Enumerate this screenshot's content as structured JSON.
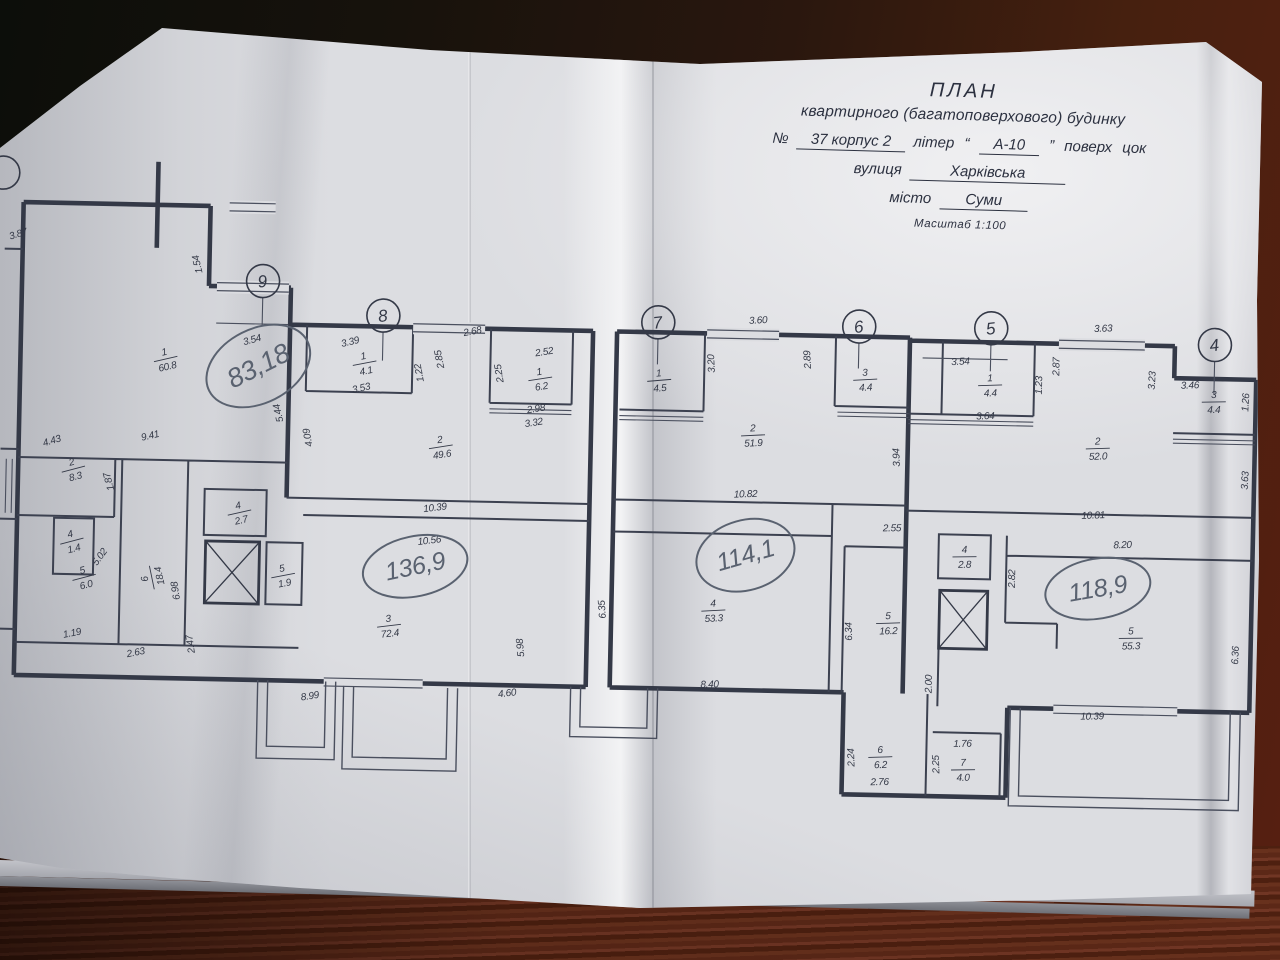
{
  "document": {
    "title1": "ПЛАН",
    "title2": "квартирного (багатоповерхового) будинку",
    "number_label": "№",
    "number_value": "37 корпус 2",
    "liter_label": "літер",
    "liter_open": "“",
    "liter_value": "А-10",
    "liter_close": "”",
    "floor_label": "поверх",
    "floor_value": "цок",
    "street_label": "вулиця",
    "street_value": "Харківська",
    "city_label": "місто",
    "city_value": "Суми",
    "scale_text": "Масштаб 1:100"
  },
  "colors": {
    "ink": "#343947",
    "pen": "#5a6270",
    "paper": "#dcdde1"
  },
  "axis_markers": [
    {
      "n": "9",
      "x": 259,
      "y": 289
    },
    {
      "n": "8",
      "x": 380,
      "y": 321
    },
    {
      "n": "7",
      "x": 655,
      "y": 322
    },
    {
      "n": "6",
      "x": 856,
      "y": 322
    },
    {
      "n": "5",
      "x": 988,
      "y": 321
    },
    {
      "n": "4",
      "x": 1212,
      "y": 333
    },
    {
      "n": "",
      "x": -3,
      "y": 186
    }
  ],
  "handwritten_totals": [
    {
      "t": "83,18",
      "x": 256,
      "y": 374,
      "r": -28,
      "rx": 55,
      "ry": 37,
      "fs": 27
    },
    {
      "t": "136,9",
      "x": 417,
      "y": 571,
      "r": -13,
      "rx": 53,
      "ry": 30,
      "fs": 25
    },
    {
      "t": "114,1",
      "x": 747,
      "y": 553,
      "r": -17,
      "rx": 50,
      "ry": 35,
      "fs": 25
    },
    {
      "t": "118,9",
      "x": 1100,
      "y": 579,
      "r": -11,
      "rx": 53,
      "ry": 30,
      "fs": 25
    }
  ],
  "rooms": [
    {
      "n": "1",
      "a": "60.8",
      "x": 163,
      "y": 368,
      "r": -14
    },
    {
      "n": "2",
      "a": "8.3",
      "x": 73,
      "y": 480,
      "r": -16
    },
    {
      "n": "4",
      "a": "1.4",
      "x": 73,
      "y": 552,
      "r": -16
    },
    {
      "n": "5",
      "a": "6.0",
      "x": 86,
      "y": 588,
      "r": -16
    },
    {
      "n": "6",
      "a": "18.4",
      "x": 153,
      "y": 588,
      "r": -103
    },
    {
      "n": "4",
      "a": "2.7",
      "x": 240,
      "y": 520,
      "r": -14
    },
    {
      "n": "5",
      "a": "1.9",
      "x": 285,
      "y": 582,
      "r": -12
    },
    {
      "n": "3",
      "a": "72.4",
      "x": 392,
      "y": 630,
      "r": -8
    },
    {
      "n": "1",
      "a": "4.1",
      "x": 362,
      "y": 368,
      "r": -12
    },
    {
      "n": "1",
      "a": "6.2",
      "x": 538,
      "y": 380,
      "r": -10
    },
    {
      "n": "2",
      "a": "49.6",
      "x": 440,
      "y": 450,
      "r": -10
    },
    {
      "n": "1",
      "a": "4.5",
      "x": 657,
      "y": 379,
      "r": -6
    },
    {
      "n": "2",
      "a": "51.9",
      "x": 752,
      "y": 432,
      "r": -4
    },
    {
      "n": "3",
      "a": "4.4",
      "x": 863,
      "y": 374,
      "r": -4
    },
    {
      "n": "4",
      "a": "53.3",
      "x": 716,
      "y": 608,
      "r": -4
    },
    {
      "n": "5",
      "a": "16.2",
      "x": 891,
      "y": 617,
      "r": -3
    },
    {
      "n": "6",
      "a": "6.2",
      "x": 886,
      "y": 751,
      "r": -3
    },
    {
      "n": "7",
      "a": "4.0",
      "x": 969,
      "y": 762,
      "r": -2
    },
    {
      "n": "1",
      "a": "4.4",
      "x": 988,
      "y": 377,
      "r": -3
    },
    {
      "n": "2",
      "a": "52.0",
      "x": 1097,
      "y": 438,
      "r": -3
    },
    {
      "n": "3",
      "a": "4.4",
      "x": 1212,
      "y": 389,
      "r": -2
    },
    {
      "n": "4",
      "a": "2.8",
      "x": 966,
      "y": 549,
      "r": -2
    },
    {
      "n": "5",
      "a": "55.3",
      "x": 1134,
      "y": 627,
      "r": -2
    }
  ],
  "dimensions": [
    {
      "t": "3.87",
      "x": 14,
      "y": 250,
      "r": -18
    },
    {
      "t": "4.43",
      "x": 52,
      "y": 456,
      "r": -18
    },
    {
      "t": "9.41",
      "x": 150,
      "y": 449,
      "r": -14
    },
    {
      "t": "1.87",
      "x": 112,
      "y": 492,
      "r": -106
    },
    {
      "t": "1.54",
      "x": 196,
      "y": 273,
      "r": -104
    },
    {
      "t": "3.54",
      "x": 250,
      "y": 351,
      "r": -16
    },
    {
      "t": "5.44",
      "x": 280,
      "y": 420,
      "r": -104
    },
    {
      "t": "5.02",
      "x": 104,
      "y": 570,
      "r": -55
    },
    {
      "t": "2.63",
      "x": 140,
      "y": 666,
      "r": -12
    },
    {
      "t": "2.47",
      "x": 197,
      "y": 653,
      "r": -100
    },
    {
      "t": "6.98",
      "x": 181,
      "y": 600,
      "r": -100
    },
    {
      "t": "1.19",
      "x": 76,
      "y": 648,
      "r": -12
    },
    {
      "t": "3.39",
      "x": 348,
      "y": 351,
      "r": -14
    },
    {
      "t": "3.53",
      "x": 360,
      "y": 397,
      "r": -14
    },
    {
      "t": "1.22",
      "x": 420,
      "y": 377,
      "r": -102
    },
    {
      "t": "2.85",
      "x": 440,
      "y": 363,
      "r": -102
    },
    {
      "t": "2.68",
      "x": 470,
      "y": 338,
      "r": -12
    },
    {
      "t": "2.52",
      "x": 542,
      "y": 357,
      "r": -10
    },
    {
      "t": "2.25",
      "x": 500,
      "y": 376,
      "r": -100
    },
    {
      "t": "2.98",
      "x": 535,
      "y": 414,
      "r": -10
    },
    {
      "t": "3.32",
      "x": 533,
      "y": 428,
      "r": -10
    },
    {
      "t": "4.09",
      "x": 310,
      "y": 444,
      "r": -102
    },
    {
      "t": "10.39",
      "x": 436,
      "y": 515,
      "r": -8
    },
    {
      "t": "10.56",
      "x": 431,
      "y": 548,
      "r": -8
    },
    {
      "t": "8.99",
      "x": 315,
      "y": 706,
      "r": -10
    },
    {
      "t": "4.60",
      "x": 512,
      "y": 699,
      "r": -8
    },
    {
      "t": "5.98",
      "x": 527,
      "y": 650,
      "r": -96
    },
    {
      "t": "3.60",
      "x": 755,
      "y": 321,
      "r": -4
    },
    {
      "t": "3.20",
      "x": 712,
      "y": 362,
      "r": -94
    },
    {
      "t": "2.89",
      "x": 808,
      "y": 356,
      "r": -94
    },
    {
      "t": "10.82",
      "x": 746,
      "y": 495,
      "r": -3
    },
    {
      "t": "6.35",
      "x": 608,
      "y": 610,
      "r": -95
    },
    {
      "t": "8.40",
      "x": 714,
      "y": 686,
      "r": -3
    },
    {
      "t": "2.55",
      "x": 893,
      "y": 526,
      "r": -2
    },
    {
      "t": "6.34",
      "x": 855,
      "y": 627,
      "r": -93
    },
    {
      "t": "2.24",
      "x": 860,
      "y": 753,
      "r": -93
    },
    {
      "t": "2.76",
      "x": 886,
      "y": 780,
      "r": -2
    },
    {
      "t": "1.76",
      "x": 968,
      "y": 740,
      "r": -2
    },
    {
      "t": "2.25",
      "x": 945,
      "y": 758,
      "r": -93
    },
    {
      "t": "3.54",
      "x": 958,
      "y": 358,
      "r": -4
    },
    {
      "t": "3.64",
      "x": 984,
      "y": 412,
      "r": -3
    },
    {
      "t": "1.23",
      "x": 1040,
      "y": 377,
      "r": -90
    },
    {
      "t": "2.87",
      "x": 1057,
      "y": 358,
      "r": -90
    },
    {
      "t": "3.63",
      "x": 1100,
      "y": 322,
      "r": -3
    },
    {
      "t": "3.94",
      "x": 899,
      "y": 452,
      "r": -93
    },
    {
      "t": "3.23",
      "x": 1153,
      "y": 370,
      "r": -88
    },
    {
      "t": "3.46",
      "x": 1188,
      "y": 377,
      "r": -3
    },
    {
      "t": "1.26",
      "x": 1247,
      "y": 390,
      "r": -88
    },
    {
      "t": "3.63",
      "x": 1248,
      "y": 468,
      "r": -88
    },
    {
      "t": "10.81",
      "x": 1094,
      "y": 509,
      "r": -3
    },
    {
      "t": "8.20",
      "x": 1124,
      "y": 538,
      "r": -3
    },
    {
      "t": "2.82",
      "x": 1017,
      "y": 571,
      "r": -90
    },
    {
      "t": "2.00",
      "x": 936,
      "y": 678,
      "r": -90
    },
    {
      "t": "10.39",
      "x": 1097,
      "y": 710,
      "r": -2
    },
    {
      "t": "6.36",
      "x": 1242,
      "y": 643,
      "r": -88
    }
  ]
}
